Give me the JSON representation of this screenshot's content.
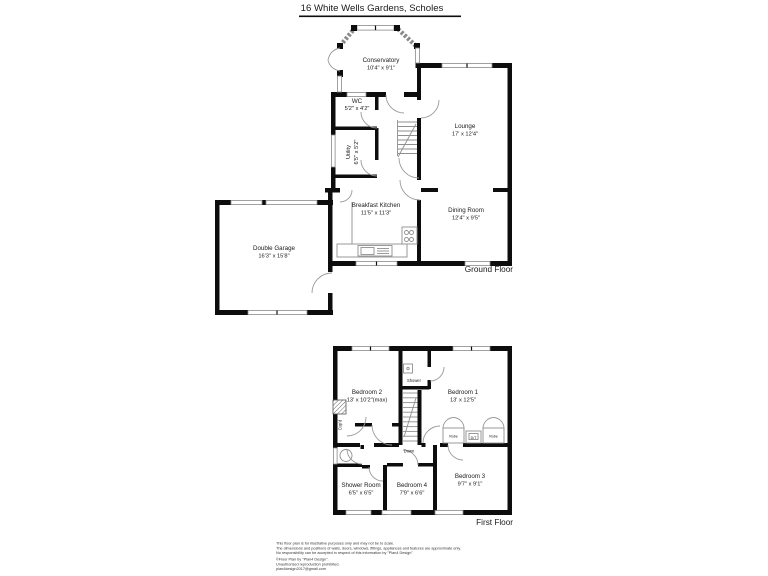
{
  "title": "16 White Wells Gardens, Scholes",
  "colors": {
    "wall": "#0d0d0d",
    "line": "#8f8f8f",
    "background": "#ffffff"
  },
  "ground_floor": {
    "label": "Ground Floor",
    "rooms": {
      "conservatory": {
        "name": "Conservatory",
        "dims": "10'4\" x 9'1\""
      },
      "wc": {
        "name": "WC",
        "dims": "5'2\" x 4'2\""
      },
      "utility": {
        "name": "Utility",
        "dims": "6'5\" x 5'2\""
      },
      "lounge": {
        "name": "Lounge",
        "dims": "17' x 12'4\""
      },
      "dining_room": {
        "name": "Dining Room",
        "dims": "12'4\" x 9'5\""
      },
      "breakfast_kitchen": {
        "name": "Breakfast Kitchen",
        "dims": "11'5\" x 11'3\""
      },
      "double_garage": {
        "name": "Double Garage",
        "dims": "16'3\" x 15'8\""
      }
    }
  },
  "first_floor": {
    "label": "First Floor",
    "rooms": {
      "bedroom_2": {
        "name": "Bedroom 2",
        "dims": "13' x 10'2\"(max)"
      },
      "bedroom_1": {
        "name": "Bedroom 1",
        "dims": "13' x 12'5\""
      },
      "shower": {
        "name": "Shower"
      },
      "cupboard": {
        "name": "Cup'd"
      },
      "shower_room": {
        "name": "Shower Room",
        "dims": "6'5\" x 6'5\""
      },
      "bedroom_4": {
        "name": "Bedroom 4",
        "dims": "7'9\" x 6'6\""
      },
      "bedroom_3": {
        "name": "Bedroom 3",
        "dims": "9'7\" x 9'1\""
      }
    },
    "fixtures": {
      "robe_left": "Robe",
      "dt": "D/T",
      "robe_right": "Robe",
      "down": "Down"
    }
  },
  "disclaimer": {
    "line1": "This floor plan is for illustrative purposes only and may not be to scale.",
    "line2": "The dimensions and positions of walls, doors, windows, fittings, appliances and features are approximate only.",
    "line3": "No responsibility can be accepted in respect of this information by \"Plan4 Design\"",
    "line4": "©Floor Plan by \"Plan4 Design\".",
    "line5": "Unauthorised reproduction prohibited.",
    "line6": "plan4design2017@gmail.com"
  }
}
